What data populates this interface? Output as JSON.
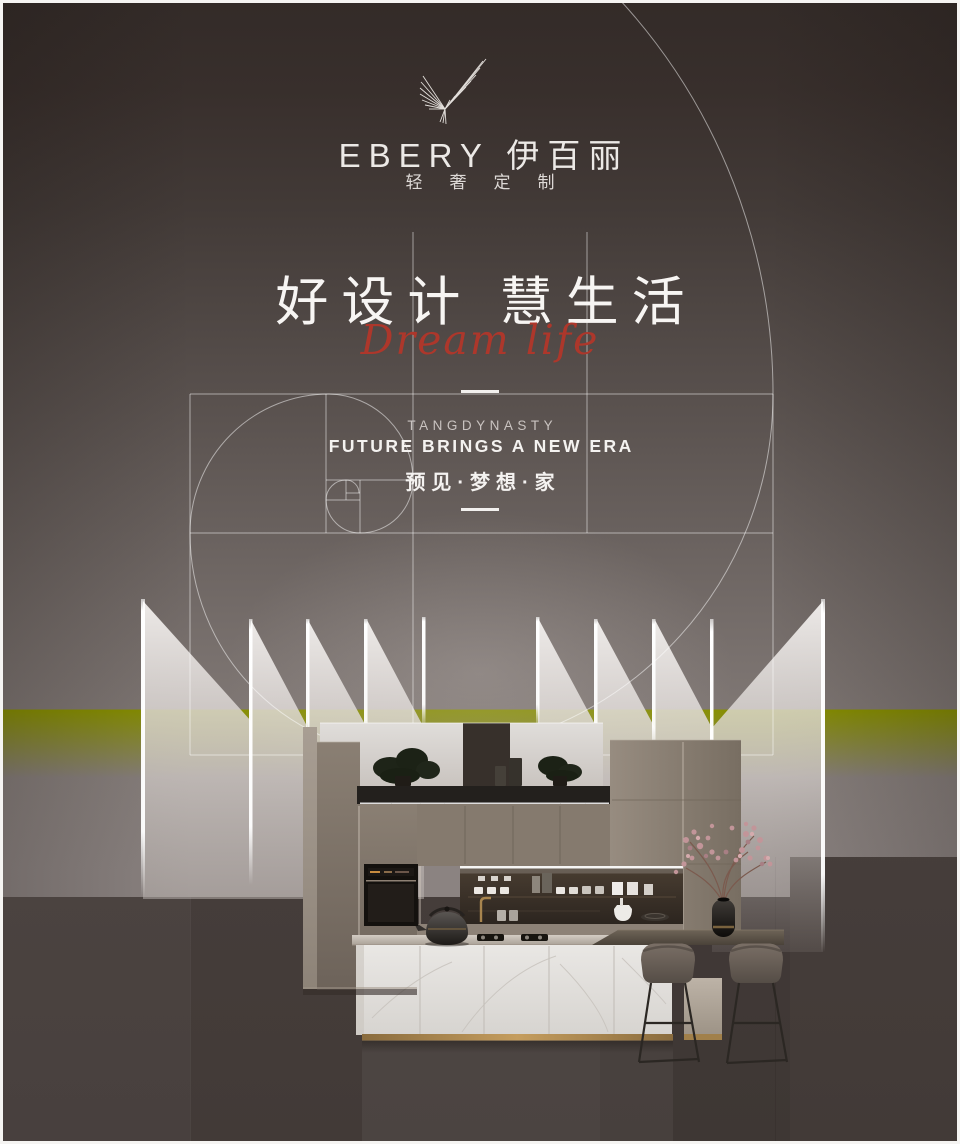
{
  "brand": {
    "logo_text": "EBERY 伊百丽",
    "tagline": "轻奢定制"
  },
  "hero": {
    "headline": "好设计 慧生活",
    "script_text": "Dream life"
  },
  "feature": {
    "kicker": "TANGDYNASTY",
    "title": "FUTURE BRINGS A NEW ERA",
    "subtitle": "预见·梦想·家"
  },
  "colors": {
    "accent_red": "#ad372b",
    "gold_accent": "#b08a50",
    "background_top": "#352d2a",
    "background_mid": "#8b8381",
    "background_bottom": "#423a37",
    "light_line": "#ffffff"
  }
}
